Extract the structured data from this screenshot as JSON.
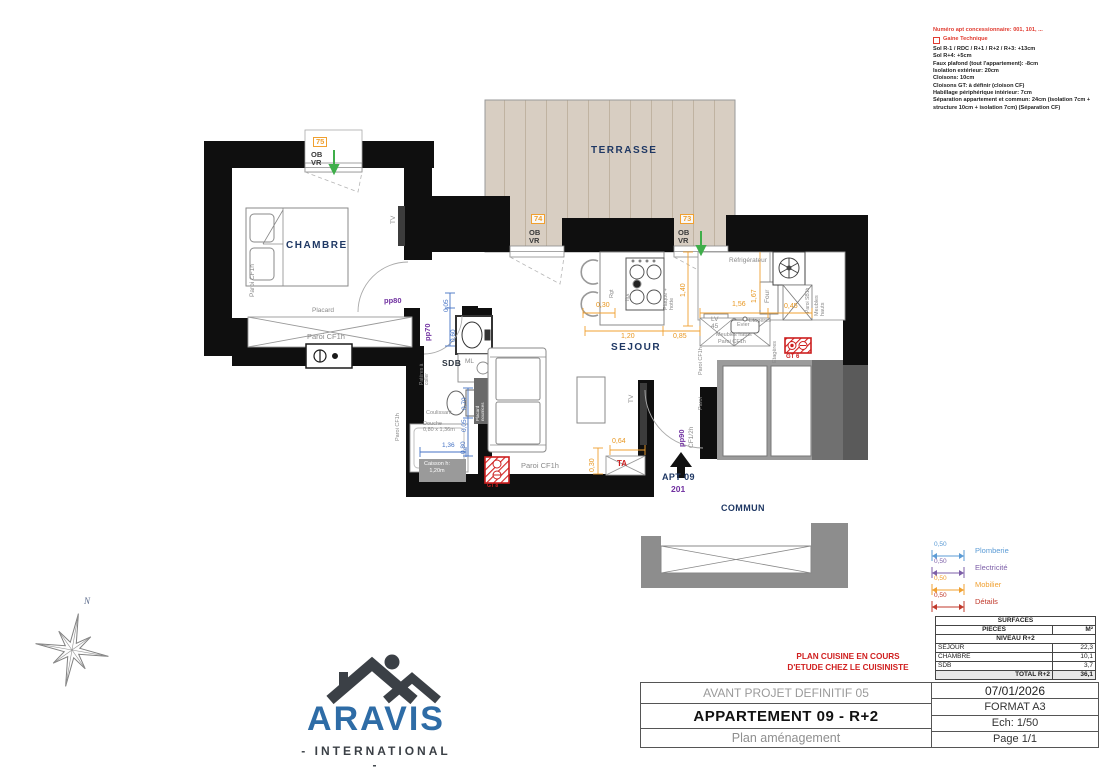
{
  "notes": {
    "concession": "Numéro apt concessionnaire: 001, 101, ...",
    "gaine": "Gaine Technique",
    "lines": [
      "Sol R-1 / RDC / R+1 / R+2 / R+3: +13cm",
      "Sol R+4: +5cm",
      "Faux plafond (tout l'appartement): -8cm",
      "Isolation extérieur: 20cm",
      "Cloisons: 10cm",
      "Cloisons GT: à définir (cloison CF)",
      "Habillage périphérique intérieur: 7cm",
      "Séparation appartement et commun: 24cm (isolation 7cm + structure 10cm + isolation 7cm) (Séparation CF)"
    ]
  },
  "legend": {
    "rows": [
      {
        "dim": "0,50",
        "label": "Plomberie",
        "color": "#5b9bd5"
      },
      {
        "dim": "0,50",
        "label": "Electricité",
        "color": "#7d5fa8"
      },
      {
        "dim": "0,50",
        "label": "Mobilier",
        "color": "#f0a030"
      },
      {
        "dim": "0,50",
        "label": "Détails",
        "color": "#c0392b"
      }
    ]
  },
  "surfaces_table": {
    "title": "SURFACES",
    "col1": "PIECES",
    "col2": "M²",
    "section": "NIVEAU R+2",
    "rows": [
      {
        "piece": "SEJOUR",
        "m2": "22,3"
      },
      {
        "piece": "CHAMBRE",
        "m2": "10,1"
      },
      {
        "piece": "SDB",
        "m2": "3,7"
      }
    ],
    "total_label": "TOTAL R+2",
    "total_value": "36,1"
  },
  "title_block": {
    "project": "AVANT PROJET DEFINITIF 05",
    "title": "APPARTEMENT 09 - R+2",
    "subtitle": "Plan aménagement",
    "date": "07/01/2026",
    "format": "FORMAT A3",
    "scale": "Ech: 1/50",
    "page": "Page 1/1"
  },
  "kitchen_note": {
    "line1": "PLAN CUISINE EN COURS",
    "line2": "D'ETUDE CHEZ LE CUISINISTE"
  },
  "logo": {
    "name": "ARAVIS",
    "subtitle": "- INTERNATIONAL -"
  },
  "compass": {
    "label": "N"
  },
  "colors": {
    "wall": "#0f0f0f",
    "terrace_floor": "#d8cec2",
    "dim_orange": "#e8961e",
    "dim_blue": "#4472c4",
    "accent_purple": "#7030a0",
    "accent_red": "#cc1f1f",
    "room_label_navy": "#1f3864",
    "logo_blue": "#2e6ca6",
    "window_green_arrow": "#3fae4a"
  },
  "plan": {
    "labels": [
      {
        "name": "terrasse",
        "text": "TERRASSE",
        "x": 591,
        "y": 146,
        "cls": "navy"
      },
      {
        "name": "chambre",
        "text": "CHAMBRE",
        "x": 286,
        "y": 241,
        "cls": "navy"
      },
      {
        "name": "sejour",
        "text": "SEJOUR",
        "x": 611,
        "y": 343,
        "cls": "navy"
      },
      {
        "name": "sdb",
        "text": "SDB",
        "x": 442,
        "y": 359,
        "cls": "sdb"
      },
      {
        "name": "apt-09",
        "text": "APT 09",
        "x": 662,
        "y": 473,
        "cls": "navy-sm"
      },
      {
        "name": "apt-num",
        "text": "201",
        "x": 671,
        "y": 485,
        "cls": "purple-num"
      },
      {
        "name": "commun",
        "text": "COMMUN",
        "x": 721,
        "y": 504,
        "cls": "navy-sm"
      },
      {
        "name": "door-pp80",
        "text": "pp80",
        "x": 384,
        "y": 297,
        "cls": "purple"
      },
      {
        "name": "door-pp70",
        "text": "pp70",
        "x": 424,
        "y": 341,
        "cls": "purple",
        "rot": 1
      },
      {
        "name": "door-pp90",
        "text": "pp90",
        "x": 678,
        "y": 447,
        "cls": "purple",
        "rot": 1
      },
      {
        "name": "door-cf12h",
        "text": "CF1/2h",
        "x": 688,
        "y": 448,
        "cls": "gray-sm",
        "rot": 1
      },
      {
        "name": "paroi-entry",
        "text": "Paroi",
        "x": 699,
        "y": 410,
        "cls": "gray-xs",
        "rot": 1
      },
      {
        "name": "placard",
        "text": "Placard",
        "x": 312,
        "y": 307,
        "cls": "gray-sm"
      },
      {
        "name": "paroi-placard",
        "text": "Paroi CF1h",
        "x": 307,
        "y": 333,
        "cls": "gray"
      },
      {
        "name": "paroi-left",
        "text": "Paroi CF1h",
        "x": 249,
        "y": 297,
        "cls": "gray-sm",
        "rot": 1
      },
      {
        "name": "paroi-bottom",
        "text": "Paroi CF1h",
        "x": 521,
        "y": 462,
        "cls": "gray"
      },
      {
        "name": "paroi-sdb",
        "text": "Paroi CF1h",
        "x": 396,
        "y": 441,
        "cls": "gray-xs",
        "rot": 1
      },
      {
        "name": "paroi-kitchen",
        "text": "Paroi CF1h",
        "x": 699,
        "y": 375,
        "cls": "gray-xs",
        "rot": 1
      },
      {
        "name": "paroi-sb1h",
        "text": "Paroi SB1h",
        "x": 806,
        "y": 313,
        "cls": "gray-xxs",
        "rot": 1
      },
      {
        "name": "tv-bedroom",
        "text": "TV",
        "x": 390,
        "y": 224,
        "cls": "gray-sm",
        "rot": 1
      },
      {
        "name": "tv-sejour",
        "text": "TV",
        "x": 628,
        "y": 403,
        "cls": "gray-sm",
        "rot": 1
      },
      {
        "name": "refrigerateur",
        "text": "Réfrigérateur",
        "x": 729,
        "y": 257,
        "cls": "gray-sm"
      },
      {
        "name": "four",
        "text": "Four",
        "x": 764,
        "y": 303,
        "cls": "gray-sm",
        "rot": 1
      },
      {
        "name": "lv-45",
        "text": "LV\n45",
        "x": 711,
        "y": 316,
        "cls": "gray-sm"
      },
      {
        "name": "evier",
        "text": "Evier",
        "x": 737,
        "y": 323,
        "cls": "gray-xs"
      },
      {
        "name": "meubles-hauts-1",
        "text": "Meubles hauts",
        "x": 716,
        "y": 333,
        "cls": "gray-xs"
      },
      {
        "name": "paroi-kitchen-2",
        "text": "Paroi CF1h",
        "x": 718,
        "y": 340,
        "cls": "gray-xs"
      },
      {
        "name": "etageres-1",
        "text": "Etagères",
        "x": 749,
        "y": 319,
        "cls": "gray-xs"
      },
      {
        "name": "etageres-2",
        "text": "Etagères",
        "x": 773,
        "y": 363,
        "cls": "gray-xs",
        "rot": 1
      },
      {
        "name": "meubles-hauts-2",
        "text": "Meubles\nhauts",
        "x": 815,
        "y": 316,
        "cls": "gray-xs",
        "rot": 1
      },
      {
        "name": "rgt",
        "text": "Rgt",
        "x": 610,
        "y": 298,
        "cls": "gray-xs",
        "rot": 1
      },
      {
        "name": "ilot",
        "text": "Ilot",
        "x": 626,
        "y": 301,
        "cls": "gray-xs",
        "rot": 1
      },
      {
        "name": "plaque-hotte",
        "text": "Plaque +\nhotte",
        "x": 664,
        "y": 310,
        "cls": "gray-xs",
        "rot": 1
      },
      {
        "name": "pateres",
        "text": "Patères à\ncoller",
        "x": 420,
        "y": 385,
        "cls": "gray-xxs",
        "rot": 1
      },
      {
        "name": "ml",
        "text": "ML",
        "x": 465,
        "y": 358,
        "cls": "gray-sm"
      },
      {
        "name": "coulissant",
        "text": "Coulissant",
        "x": 426,
        "y": 411,
        "cls": "gray-xs"
      },
      {
        "name": "douche",
        "text": "Douche\n0,80 x 1,36m",
        "x": 423,
        "y": 422,
        "cls": "gray-xs"
      },
      {
        "name": "caisson",
        "text": "Caisson h:\n1,20m",
        "x": 424,
        "y": 461,
        "cls": "white-sm"
      },
      {
        "name": "placard-nourrices",
        "text": "Placard\nnourrices",
        "x": 476,
        "y": 421,
        "cls": "white-xxs",
        "rot": 1
      },
      {
        "name": "ob-vr-75",
        "text": "OB\nVR",
        "x": 311,
        "y": 151,
        "cls": "ob"
      },
      {
        "name": "ob-vr-74",
        "text": "OB\nVR",
        "x": 529,
        "y": 229,
        "cls": "ob"
      },
      {
        "name": "ob-vr-73",
        "text": "OB\nVR",
        "x": 678,
        "y": 229,
        "cls": "ob"
      },
      {
        "name": "win-75",
        "text": "75",
        "x": 313,
        "y": 137,
        "cls": "obox"
      },
      {
        "name": "win-74",
        "text": "74",
        "x": 531,
        "y": 214,
        "cls": "obox"
      },
      {
        "name": "win-73",
        "text": "73",
        "x": 680,
        "y": 214,
        "cls": "obox"
      },
      {
        "name": "gt-6",
        "text": "GT 6",
        "x": 786,
        "y": 354,
        "cls": "red-xs"
      },
      {
        "name": "gt-8",
        "text": "GT 8",
        "x": 487,
        "y": 484,
        "cls": "red-xxs"
      },
      {
        "name": "ta",
        "text": "TA",
        "x": 617,
        "y": 460,
        "cls": "red-ta"
      },
      {
        "name": "dim-0-05-a",
        "text": "0,05",
        "x": 443,
        "y": 312,
        "cls": "blue",
        "rot": 1
      },
      {
        "name": "dim-0-60",
        "text": "0,60",
        "x": 450,
        "y": 342,
        "cls": "blue",
        "rot": 1
      },
      {
        "name": "dim-0-70",
        "text": "0,70",
        "x": 461,
        "y": 410,
        "cls": "blue",
        "rot": 1
      },
      {
        "name": "dim-0-05-b",
        "text": "0,05",
        "x": 461,
        "y": 432,
        "cls": "blue",
        "rot": 1
      },
      {
        "name": "dim-0-80",
        "text": "0,80",
        "x": 460,
        "y": 454,
        "cls": "blue",
        "rot": 1
      },
      {
        "name": "dim-1-36",
        "text": "1,36",
        "x": 442,
        "y": 442,
        "cls": "blue"
      },
      {
        "name": "dim-0-30-a",
        "text": "0,30",
        "x": 596,
        "y": 302,
        "cls": "orange"
      },
      {
        "name": "dim-1-20",
        "text": "1,20",
        "x": 621,
        "y": 333,
        "cls": "orange"
      },
      {
        "name": "dim-0-85",
        "text": "0,85",
        "x": 673,
        "y": 333,
        "cls": "orange"
      },
      {
        "name": "dim-1-40",
        "text": "1,40",
        "x": 680,
        "y": 297,
        "cls": "orange",
        "rot": 1
      },
      {
        "name": "dim-1-56",
        "text": "1,56",
        "x": 732,
        "y": 301,
        "cls": "orange"
      },
      {
        "name": "dim-1-67",
        "text": "1,67",
        "x": 751,
        "y": 303,
        "cls": "orange",
        "rot": 1
      },
      {
        "name": "dim-0-45",
        "text": "0,45",
        "x": 784,
        "y": 303,
        "cls": "orange"
      },
      {
        "name": "dim-0-64",
        "text": "0,64",
        "x": 612,
        "y": 438,
        "cls": "orange"
      },
      {
        "name": "dim-0-30-b",
        "text": "0,30",
        "x": 589,
        "y": 472,
        "cls": "orange",
        "rot": 1
      }
    ]
  }
}
